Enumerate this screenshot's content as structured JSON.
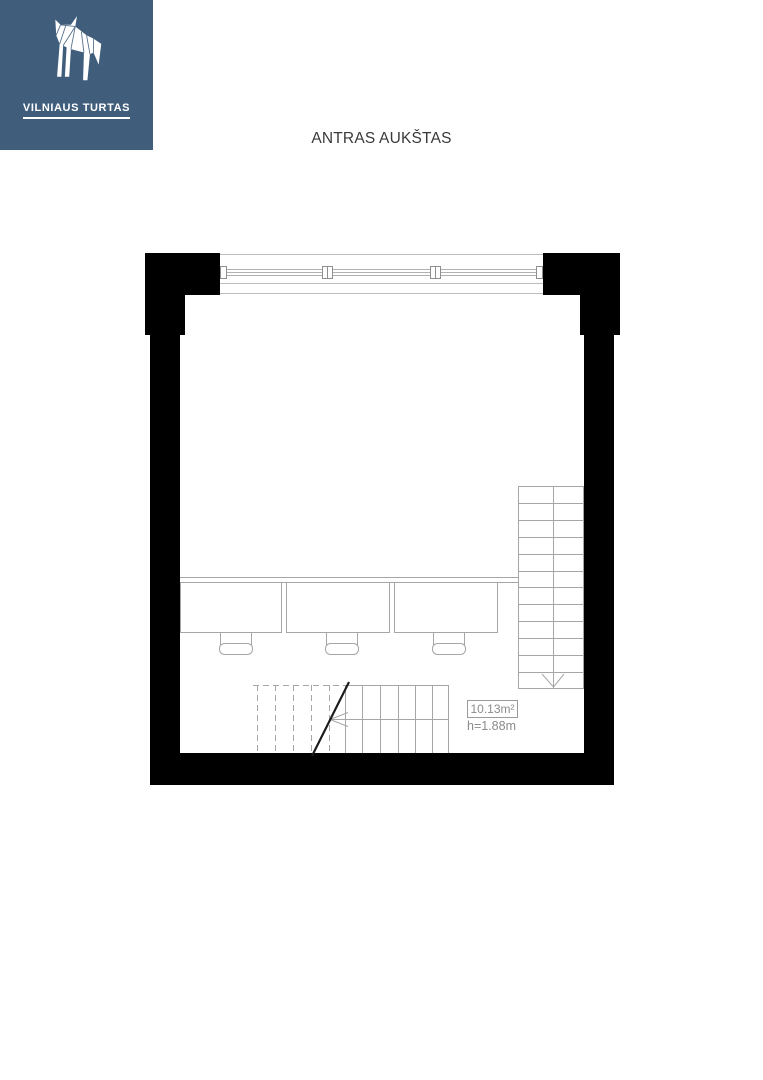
{
  "page": {
    "background": "#ffffff"
  },
  "logo": {
    "brand": "VILNIAUS TURTAS",
    "background_color": "#405e7c",
    "foreground_color": "#ffffff",
    "icon": "wolf-logo-icon"
  },
  "title": "ANTRAS AUKŠTAS",
  "floor_plan": {
    "room_label": {
      "area": "10.13m²",
      "height": "h=1.88m"
    },
    "colors": {
      "wall_fill": "#000000",
      "drawing_line": "#a6a6a6",
      "faint_line": "#bdbdbd",
      "break_line": "#1c1c1c",
      "label_text": "#8b8b8b",
      "label_border": "#9a9a9a"
    },
    "stairs": {
      "right_flight": {
        "treads": 12,
        "direction_icon": "down-arrow-icon"
      },
      "bottom_flight": {
        "solid_treads": 7,
        "dashed_treads": 5,
        "walk_line_icon": "left-arrow-icon"
      }
    },
    "furniture": {
      "desks": 3,
      "chairs": 3
    },
    "window": {
      "mullions": 2
    }
  }
}
